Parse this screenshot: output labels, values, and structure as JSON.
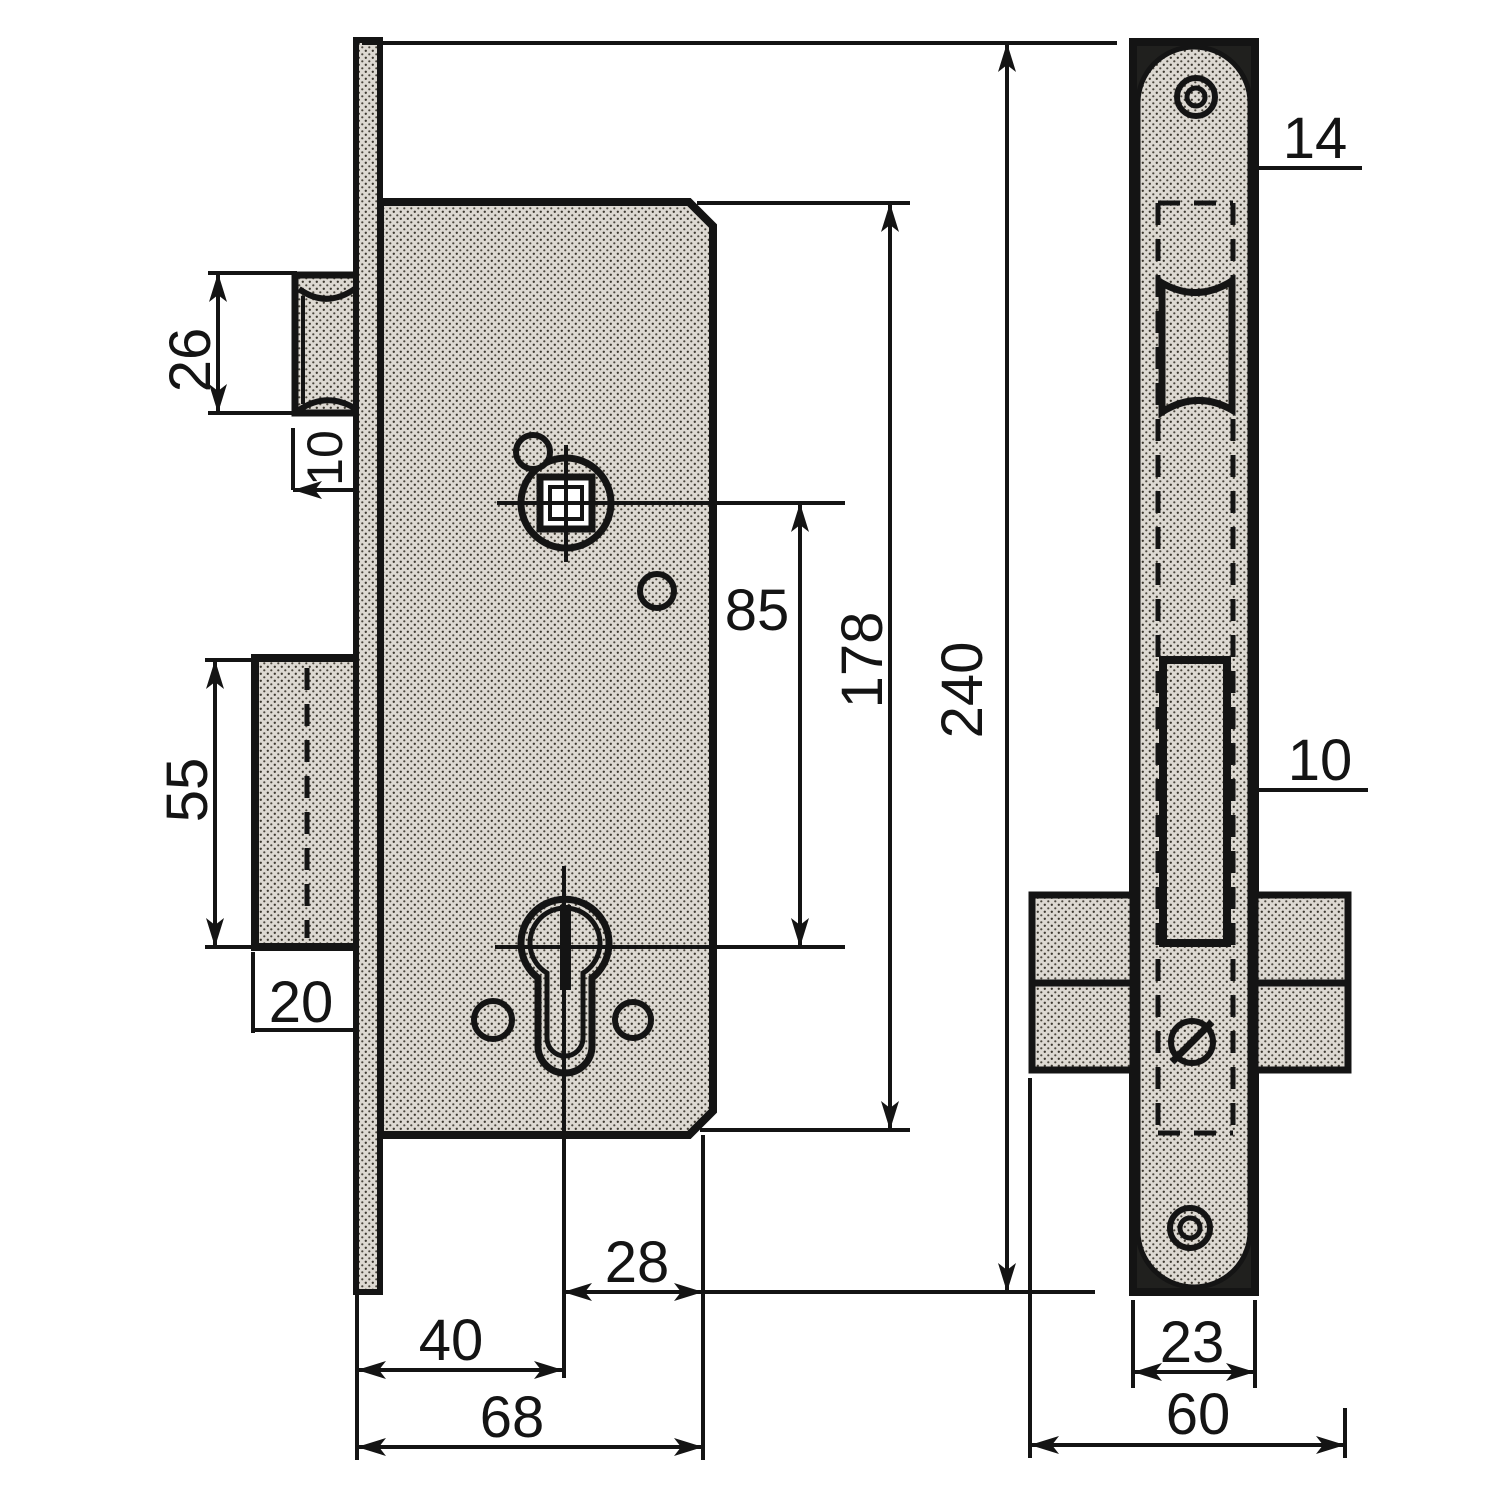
{
  "palette": {
    "ink": "#141414",
    "paper": "#ffffff",
    "metal_halftone": "#ddd9d2"
  },
  "views": {
    "front": {
      "dims": {
        "latch_height": "26",
        "latch_protrusion": "10",
        "deadbolt_height": "55",
        "deadbolt_protrusion": "20",
        "spindle_to_cylinder": "85",
        "case_height": "178",
        "faceplate_height": "240",
        "axis_to_back": "28",
        "backset": "40",
        "case_depth": "68"
      }
    },
    "side": {
      "dims": {
        "case_thickness": "14",
        "deadbolt_thickness": "10",
        "faceplate_width": "23",
        "escutcheon_width": "60"
      }
    }
  }
}
